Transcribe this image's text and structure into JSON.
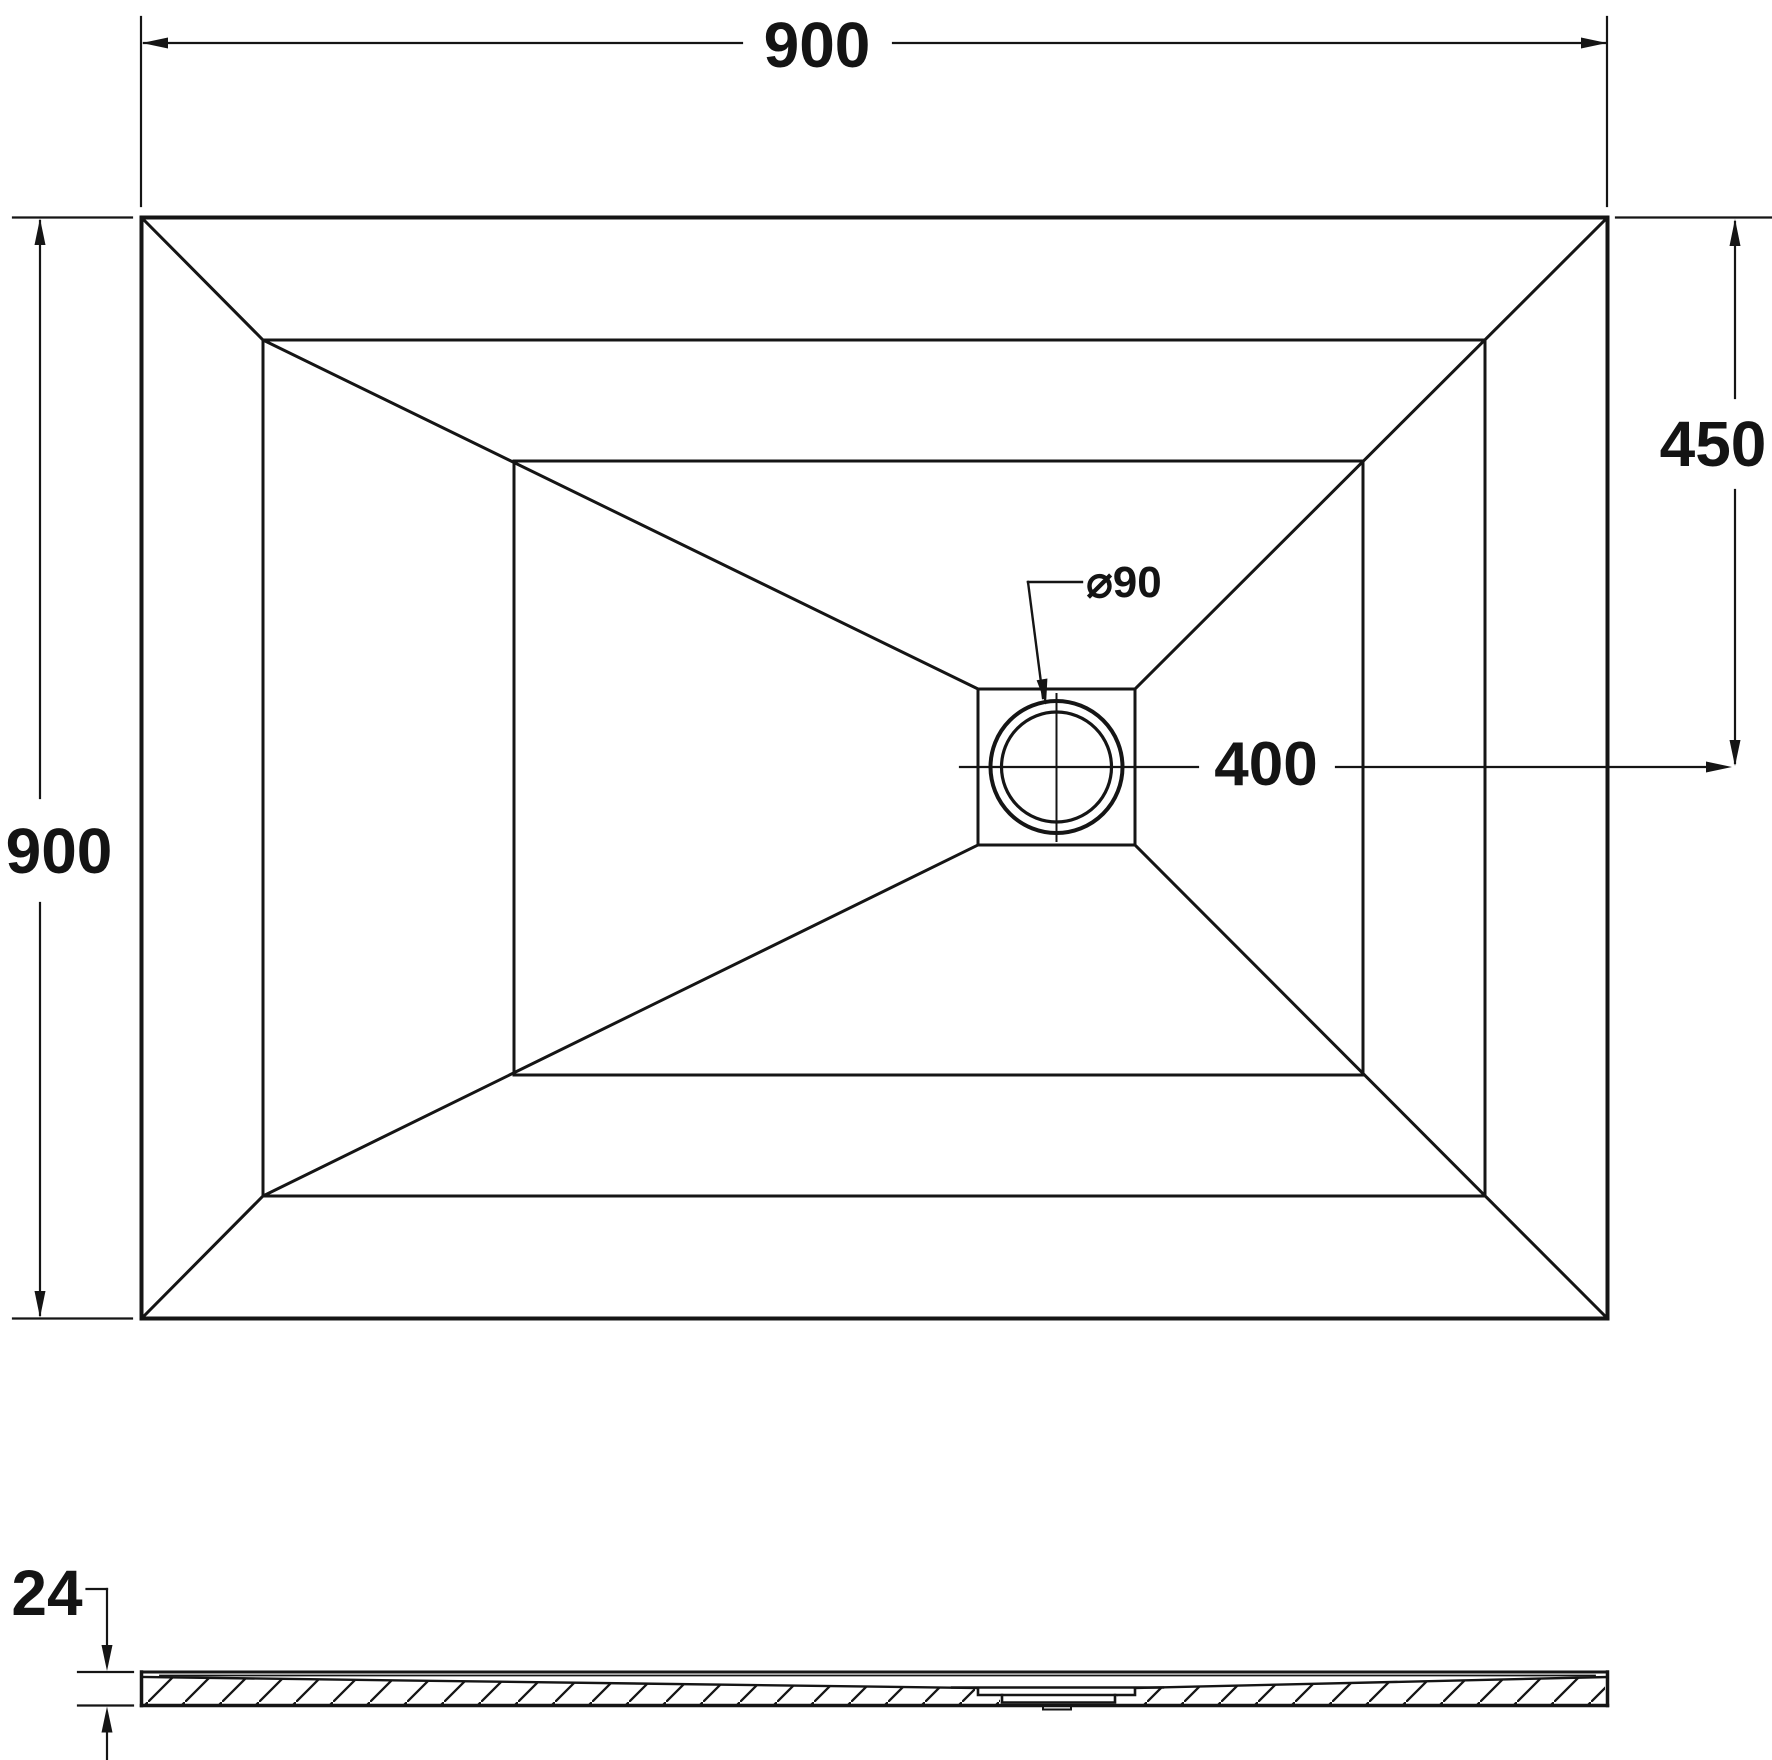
{
  "page": {
    "background": "#ffffff",
    "line_color": "#151515",
    "description": "Technical dimension drawing of rectangular shower tray, plan view and side section"
  },
  "plan_view": {
    "width_dim_label": "900",
    "depth_dim_label": "900",
    "drain_vertical_offset_dim_label": "450",
    "drain_horizontal_offset_dim_label": "400",
    "drain_diameter_label": "⌀90"
  },
  "section_view": {
    "thickness_dim_label": "24"
  }
}
